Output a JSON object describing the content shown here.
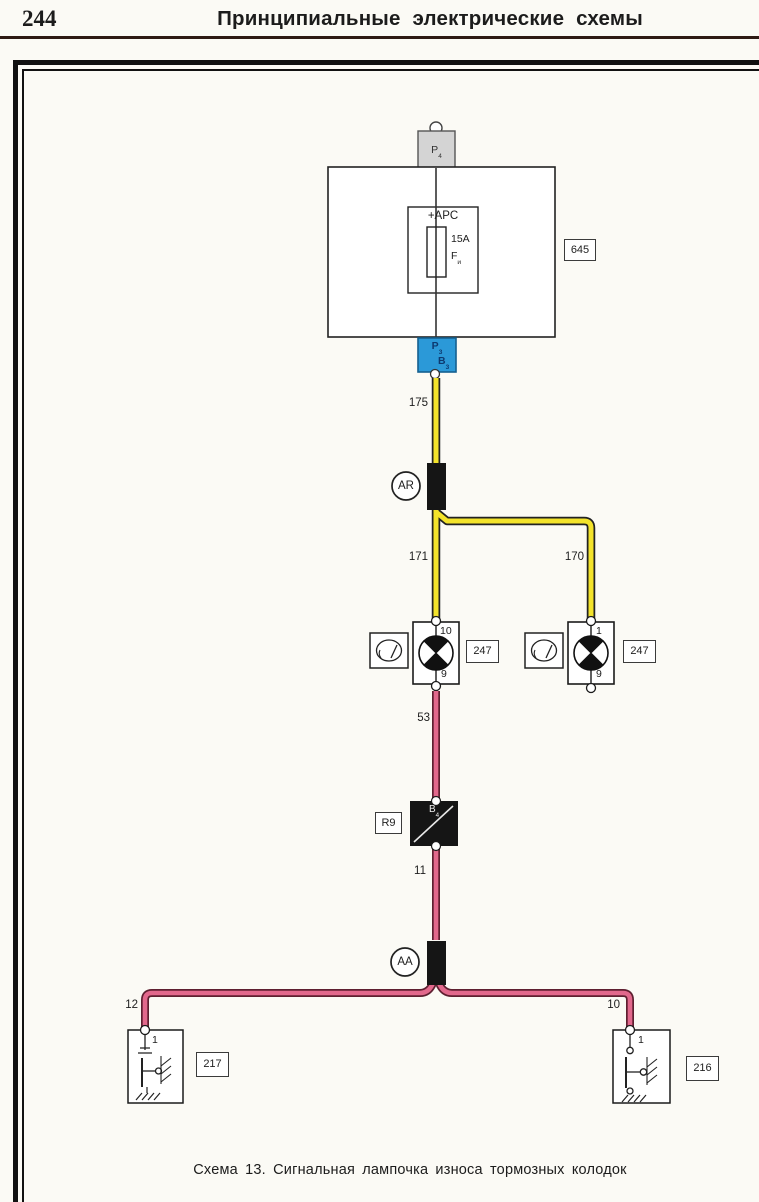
{
  "page": {
    "number": "244",
    "header_title": "Принципиальные  электрические  схемы",
    "caption": "Схема 13. Сигнальная лампочка износа тормозных колодок"
  },
  "colors": {
    "wire_yellow": "#f3e32b",
    "wire_yellow_outline": "#222222",
    "wire_pink": "#e2688c",
    "wire_pink_outline": "#5e1f30",
    "connector_blue": "#2b99d8",
    "connector_gray": "#d4d4d4",
    "block_black": "#151515",
    "header_rule": "#2e1a14"
  },
  "diagram": {
    "top_connector": {
      "label": "P",
      "label_sub": "4"
    },
    "unit_645": {
      "ref": "645",
      "supply_label": "+APC",
      "fuse_rating": "15A",
      "fuse_name": "F",
      "fuse_name_sub": "и"
    },
    "blue_connector": {
      "top": "P",
      "top_sub": "3",
      "bottom": "B",
      "bottom_sub": "3"
    },
    "junction_ar": {
      "label": "AR"
    },
    "junction_aa": {
      "label": "AA"
    },
    "black_unit": {
      "ref": "R9",
      "label": "B",
      "label_sub": "4"
    },
    "lamp_left": {
      "pin_top": "10",
      "pin_bottom": "9",
      "ref": "247"
    },
    "lamp_right": {
      "pin_top": "1",
      "pin_bottom": "9",
      "ref": "247"
    },
    "sensor_left": {
      "pin": "1",
      "ref": "217"
    },
    "sensor_right": {
      "pin": "1",
      "ref": "216"
    },
    "wires": {
      "w175": "175",
      "w171": "171",
      "w170": "170",
      "w53": "53",
      "w11": "11",
      "w12": "12",
      "w10": "10"
    }
  }
}
